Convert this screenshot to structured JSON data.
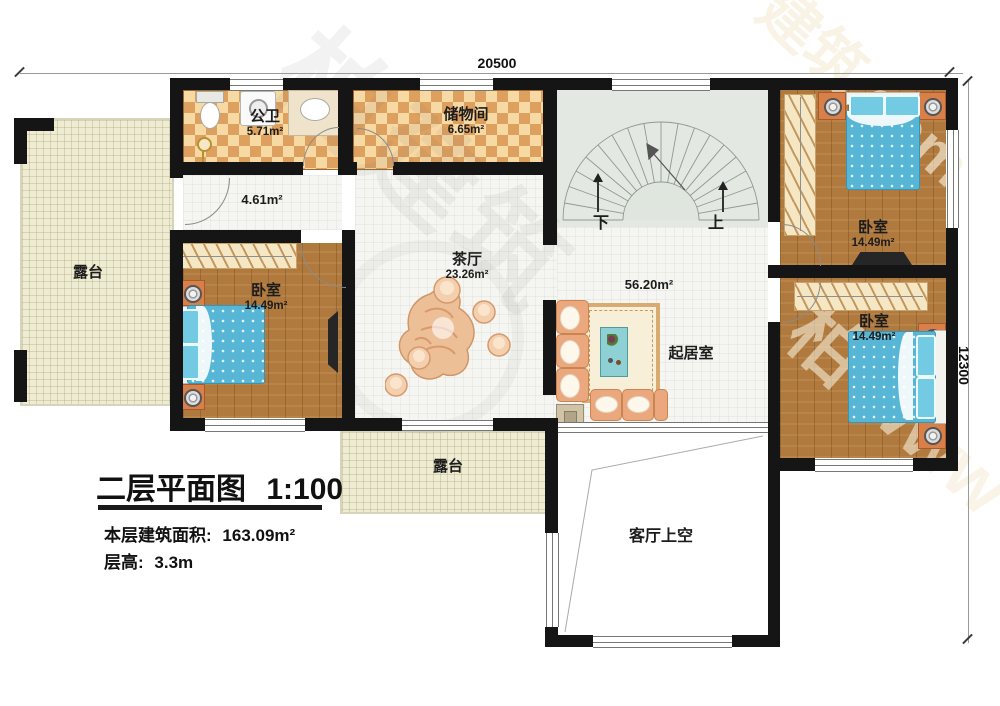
{
  "dims": {
    "top": "20500",
    "right": "12300"
  },
  "rooms": {
    "bathroom": {
      "name": "公卫",
      "area": "5.71m²"
    },
    "storage": {
      "name": "储物间",
      "area": "6.65m²"
    },
    "hallway": {
      "area": "4.61m²"
    },
    "tea_hall": {
      "name": "茶厅",
      "area": "23.26m²"
    },
    "living": {
      "name": "起居室",
      "area": "56.20m²"
    },
    "bedroom_left": {
      "name": "卧室",
      "area": "14.49m²"
    },
    "bedroom_top_right": {
      "name": "卧室",
      "area": "14.49m²"
    },
    "bedroom_mid_right": {
      "name": "卧室",
      "area": "14.49m²"
    },
    "terrace_left": {
      "name": "露台"
    },
    "terrace_bottom": {
      "name": "露台"
    },
    "void": {
      "name": "客厅上空"
    }
  },
  "stairs": {
    "down_label": "下",
    "up_label": "上"
  },
  "titleblock": {
    "plan_title": "二层平面图",
    "plan_scale": "1:100",
    "floor_area_label": "本层建筑面积:",
    "floor_area_value": "163.09m²",
    "floor_height_label": "层高:",
    "floor_height_value": "3.3m"
  },
  "watermark": {
    "center": "柏建筑",
    "top_right": "建筑.com",
    "bottom_right": "柏 www"
  },
  "colors": {
    "wall": "#151515",
    "checker-light": "#f7d9a4",
    "checker-dark": "#dda05f",
    "wood": "#b07a3e",
    "terrace": "#efecd4",
    "tile": "#f5f5f1",
    "stair": "#e3e9e2",
    "bed-blue": "#57b6d6",
    "pillow-cyan": "#72cbe2",
    "sofa-tan": "#eba87e",
    "accent-orange": "#d97f4a",
    "label": "#1c1c1c"
  }
}
